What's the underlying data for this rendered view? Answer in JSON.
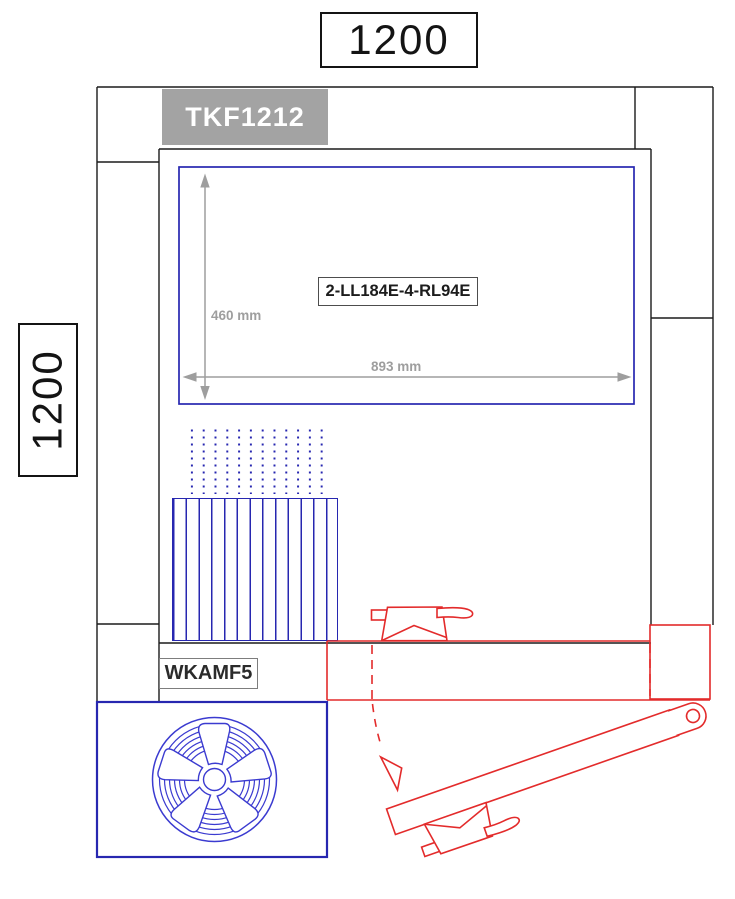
{
  "drawing_title": "ventilation-unit-section-drawing",
  "dimensions": {
    "width_label": "1200",
    "height_label": "1200",
    "opening_height": "460 mm",
    "opening_width": "893 mm"
  },
  "components": {
    "unit_model": "TKF1212",
    "heater_model": "2-LL184E-4-RL94E",
    "filter_model": "WKAMF5"
  },
  "icons": {
    "fan": "axial-fan-icon",
    "filter": "filter-hatch-pattern",
    "airflow": "airflow-dots-pattern",
    "damper_closed": "damper-actuator-closed-icon",
    "damper_open": "damper-blade-open-icon",
    "swing_arrow": "swing-direction-arrow-icon",
    "vertical_dimension": "vertical-dimension-arrow",
    "horizontal_dimension": "horizontal-dimension-arrow"
  },
  "colors": {
    "frame": "#1b1b1b",
    "blue": "#2727b0",
    "fan_blue": "#3b3bd0",
    "red": "#e32b2b",
    "dim_gray": "#9e9e9e",
    "panel_gray": "#a3a3a3"
  }
}
